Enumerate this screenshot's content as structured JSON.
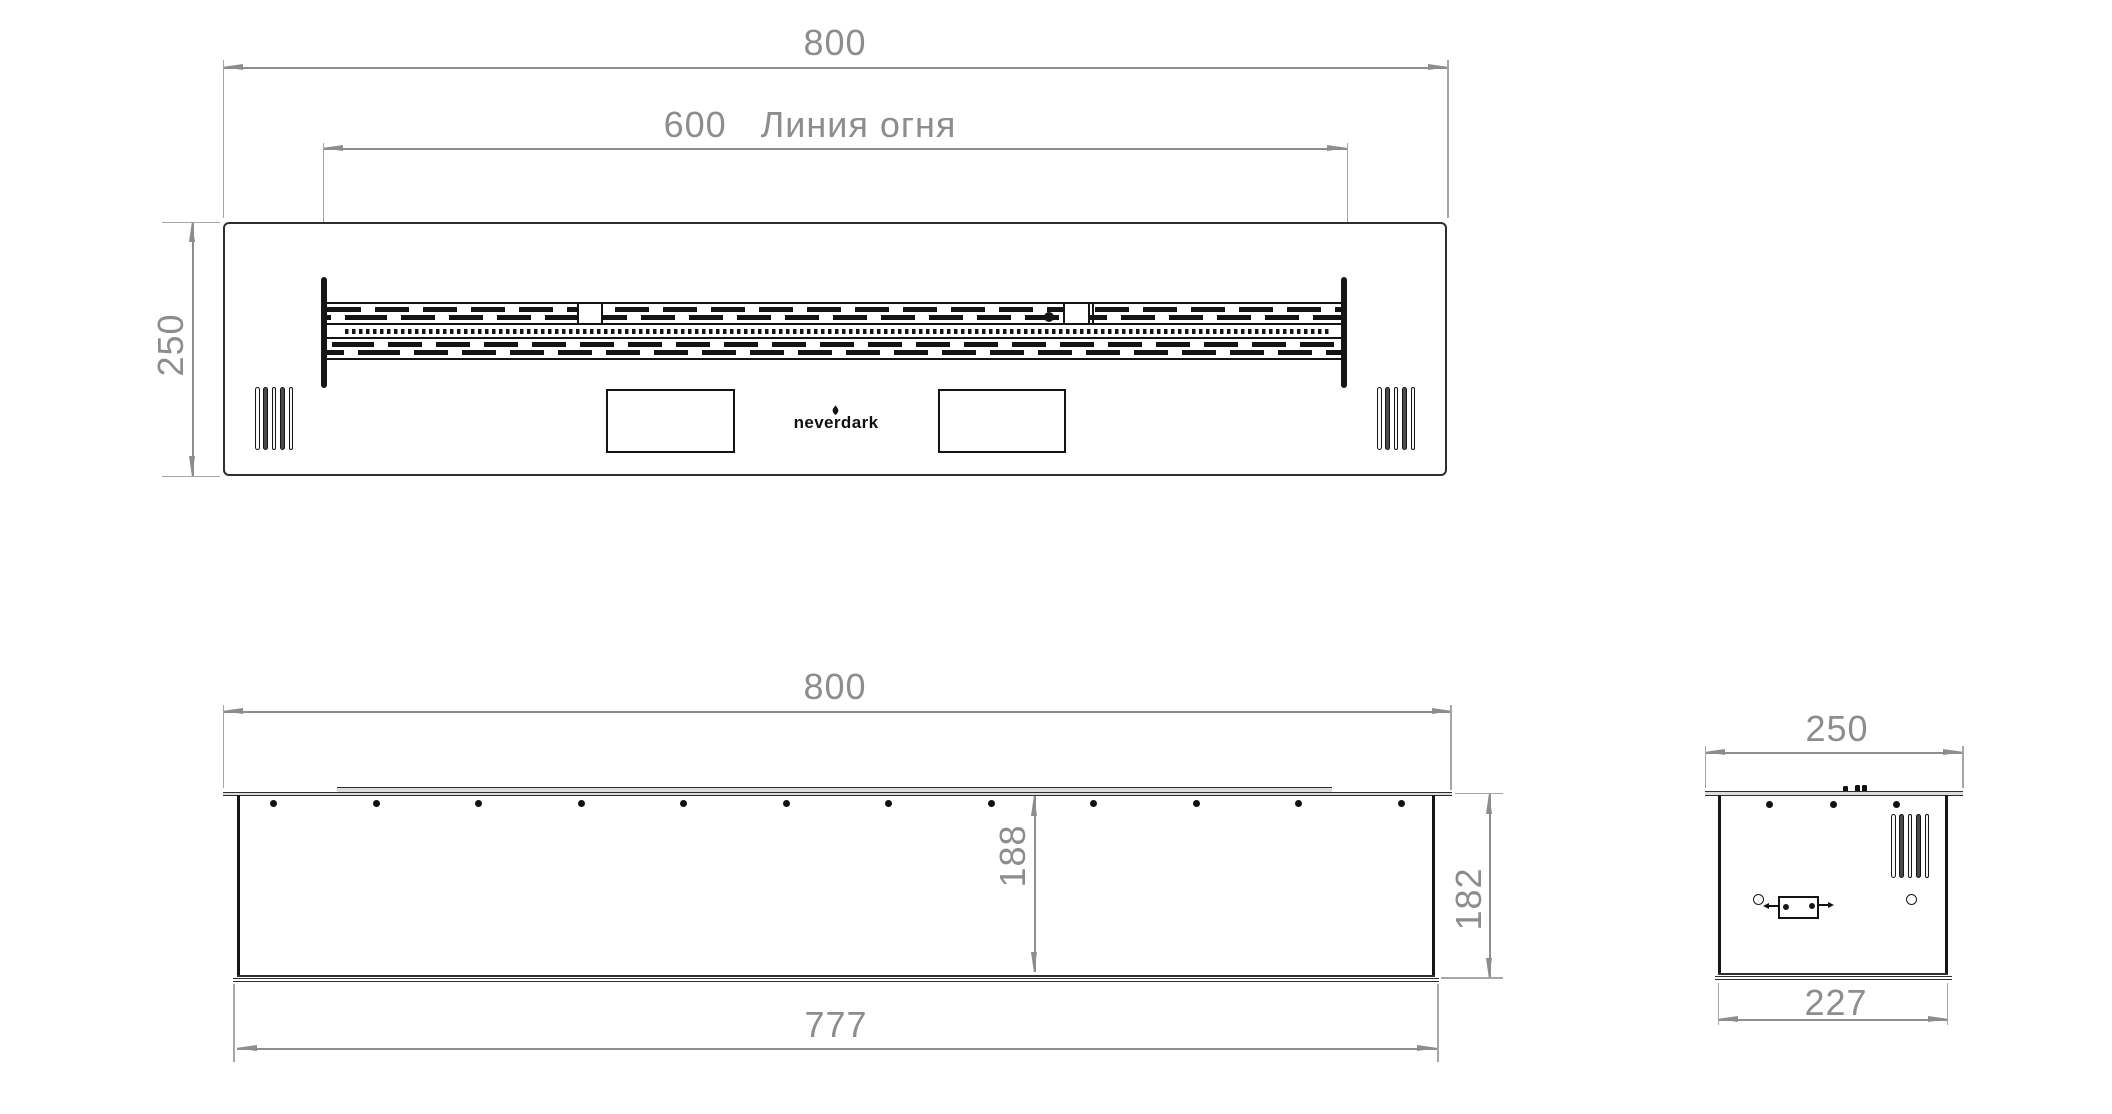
{
  "colors": {
    "background": "#ffffff",
    "line": "#161616",
    "dimension": "#8d8d8d"
  },
  "top_view": {
    "width_dim": "800",
    "fire_line_dim": "600",
    "fire_line_label": "Линия огня",
    "height_dim": "250",
    "logo_text": "neverdark"
  },
  "front_view": {
    "width_dim": "800",
    "inner_height_dim": "188",
    "height_dim": "182",
    "bottom_width_dim": "777"
  },
  "side_view": {
    "depth_dim": "250",
    "bottom_depth_dim": "227"
  }
}
